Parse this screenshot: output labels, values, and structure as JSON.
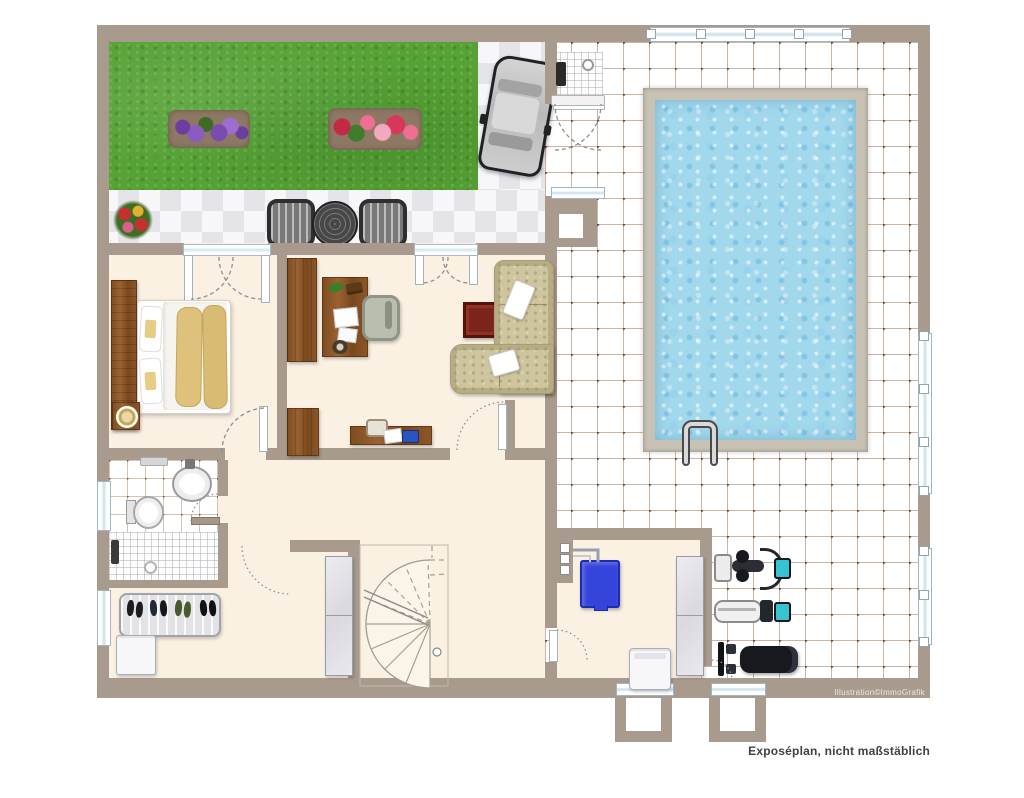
{
  "texts": {
    "disclaimer": "Exposéplan, nicht maßstäblich",
    "watermark": "Illustration©ImmoGrafik"
  },
  "palette": {
    "wall": "#a89b8d",
    "floor": "#faf1e3",
    "lawn": "#56a235",
    "soil": "#8d7863",
    "water": "#a2d8ec",
    "pooledge": "#c8c2b5",
    "tileline": "rgba(154,104,72,0.5)",
    "tiledot": "#6d4c38",
    "checker": "#e4e4e9",
    "wood": "#8a5527",
    "sofa": "#cec49e",
    "boiler": "#3544da",
    "dark": "#17191f",
    "teal": "#37c3d2",
    "frame": "#9eb6c0",
    "textgray": "#414141"
  },
  "objects": [
    "lawn",
    "flower-bed-purple",
    "flower-bed-red",
    "flower-pot",
    "bistro-set",
    "car",
    "outdoor-shower",
    "pool",
    "pool-ladder",
    "bed",
    "nightstand-clock",
    "bookshelf",
    "desk",
    "office-chair",
    "small-desk",
    "laptop",
    "sofa",
    "side-table",
    "toilet",
    "sink",
    "shower",
    "shoe-rack",
    "storage-box",
    "wardrobe",
    "winder-staircase",
    "boiler",
    "washing-machine",
    "utility-cabinet",
    "exercise-bike",
    "rowing-machine",
    "weight-bench",
    "light-well"
  ]
}
